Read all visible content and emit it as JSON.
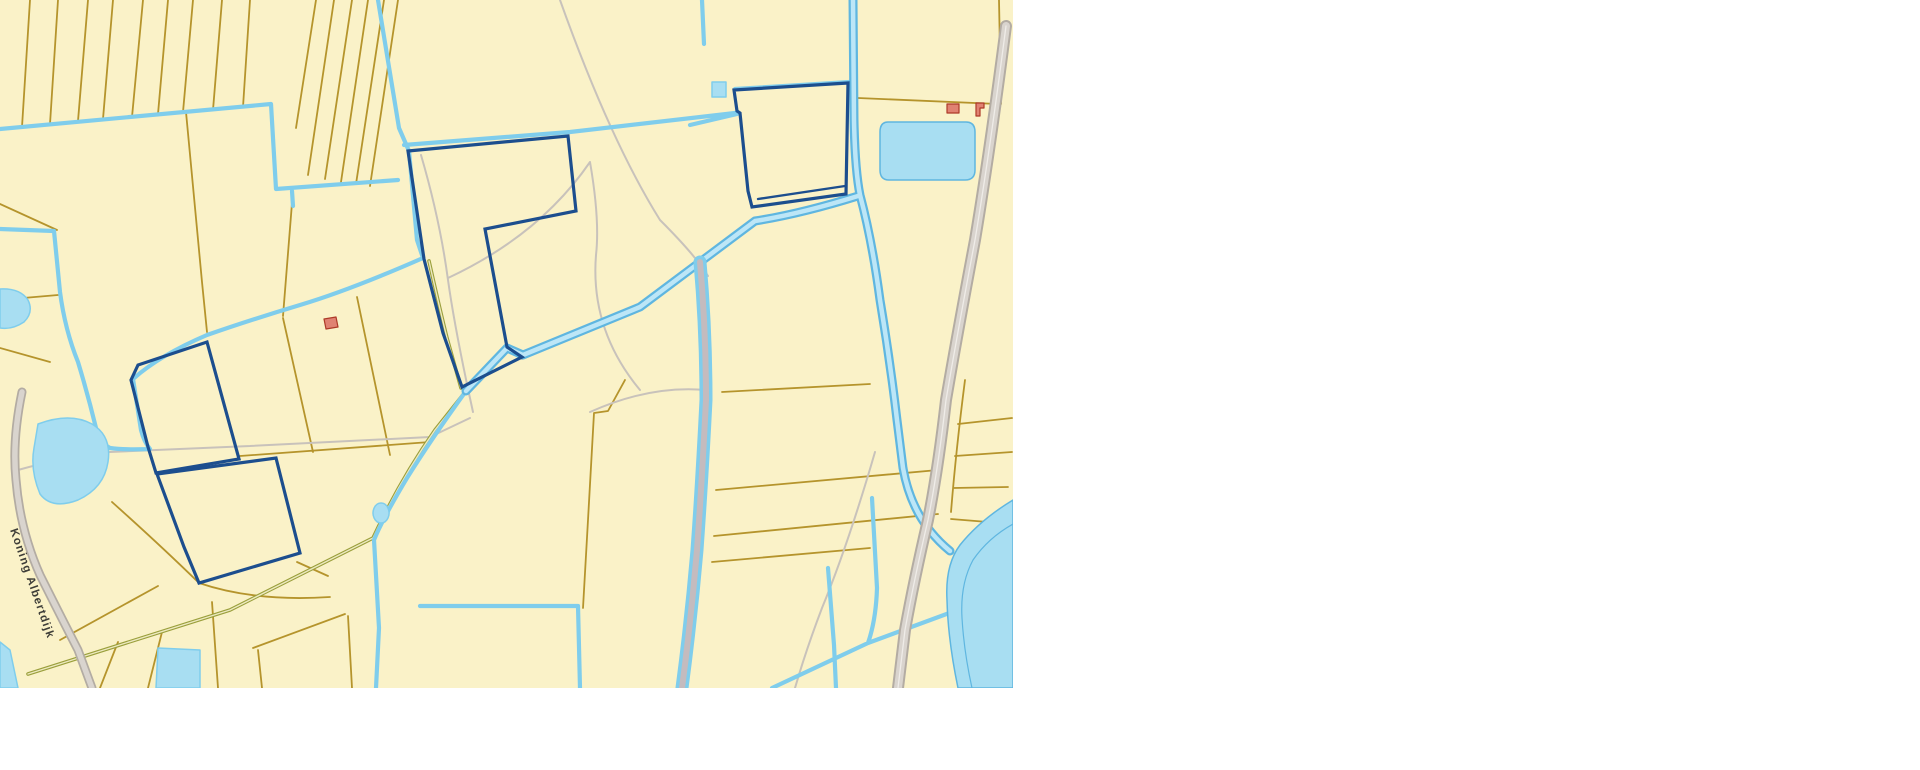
{
  "page": {
    "background": "#ffffff"
  },
  "map": {
    "width": 1013,
    "height": 688,
    "road_label": "Koning Albertdijk",
    "colors": {
      "parcel_fill": "#FAF2C8",
      "parcel_line": "#B5942C",
      "water_line": "#7FCDEC",
      "water_fill": "#A8DEF2",
      "water_deep": "#5FB6E0",
      "water_light": "#BCE6F7",
      "selection": "#1C4E8E",
      "road_casing": "#B3ACA3",
      "road_fill": "#D9D4CE",
      "road_center": "#EFECE8",
      "path_grey": "#C8C2BB",
      "towpath": "#C4BBBE",
      "dirt_road": "#9A9F3B",
      "dirt_center": "#EDE9C0",
      "building_fill": "#E08272",
      "building_stroke": "#AD3A28",
      "label_color": "#3E3E38"
    },
    "label": {
      "x": 10,
      "y": 530,
      "angle": 71,
      "size": 11.5
    },
    "features": [
      {
        "name": "map-background",
        "d": "M0,0 H1013 V688 H0 Z",
        "fill": "$parcel_fill",
        "stroke": "none",
        "w": 0,
        "inter": false
      },
      {
        "name": "parcel-lines-topleft",
        "d": "M30,0 L22,127 M58,0 L50,124 M88,0 L78,121 M113,0 L103,119 M143,0 L132,117 M168,0 L158,114 M193,0 L183,112 M222,0 L213,110 M250,0 L243,107 M316,0 L296,128 M334,0 L308,175 M352,0 L325,179 M368,0 L341,182 M384,0 L356,184 M398,0 L370,186 M186,112 L202,282 L207,332 M0,204 L57,230 M0,300 L58,295 M0,348 L50,362",
        "stroke": "$parcel_line",
        "w": 1.8,
        "fill": "none",
        "inter": false
      },
      {
        "name": "parcel-lines-center",
        "d": "M292,203 L283,316 M283,318 L313,452 M357,297 L390,455 M240,456 L430,442 M625,380 L608,411 L594,413 L588,520 L583,608 M112,502 Q160,545 198,582 M199,583 Q255,602 330,597 M297,562 L328,576",
        "stroke": "$parcel_line",
        "w": 1.8,
        "fill": "none",
        "inter": false
      },
      {
        "name": "parcel-lines-right",
        "d": "M722,392 L870,384 M716,490 L938,470 M714,536 L938,514 M712,562 L870,548 M858,98 L998,104 M999,0 L1001,104 M958,424 L1012,418 M955,456 L1012,452 M953,488 L1008,487 M951,519 L1000,523 M965,380 Q956,450 951,512",
        "stroke": "$parcel_line",
        "w": 1.8,
        "fill": "none",
        "inter": false
      },
      {
        "name": "parcel-lines-bottom",
        "d": "M60,640 L158,586 M100,688 L118,642 M148,688 L162,632 M212,602 L218,688 M253,648 L345,614 M258,650 L262,688 M348,616 L352,688",
        "stroke": "$parcel_line",
        "w": 1.8,
        "fill": "none",
        "inter": false
      },
      {
        "name": "footpaths",
        "d": "M421,155 Q440,220 448,280 Q455,330 473,412 M448,278 Q540,235 590,162 M590,162 Q600,220 596,255 Q590,330 640,390 M250,446 L430,437 L470,418 M18,470 Q60,458 110,452 L250,446 M560,0 Q610,140 660,220 Q696,256 708,276 M590,412 Q650,385 706,390 M875,452 Q848,545 822,608 Q806,650 795,688 M522,359 L640,310 L750,226",
        "stroke": "$path_grey",
        "w": 2,
        "fill": "none",
        "inter": false
      },
      {
        "name": "dirt-road",
        "d": "M28,674 L230,610 L373,538 M373,538 Q400,480 435,430 L466,391 M429,261 Q440,310 447,338 L461,388",
        "stroke": "$dirt_road",
        "w": 3.6,
        "fill": "none",
        "inter": false
      },
      {
        "name": "dirt-road-center",
        "d": "M28,674 L230,610 L373,538 M373,538 Q400,480 435,430 L466,391 M429,261 Q440,310 447,338 L461,388",
        "stroke": "$dirt_center",
        "w": 1.4,
        "fill": "none",
        "inter": false
      },
      {
        "name": "ditches-waterlines",
        "d": "M0,129 L271,104 L276,189 L398,180 M292,191 L293,206 M378,0 L399,128 L409,151 L417,240 L423,258 M423,258 Q350,290 300,305 Q250,320 207,335 Q160,355 133,379 L141,430 Q144,442 150,449 M150,449 Q125,450 110,448 L96,440 M0,229 L54,231 L60,292 Q65,330 78,362 Q88,395 96,428 M466,391 Q432,438 407,478 Q383,518 374,540 L379,628 L376,688 M420,606 L578,606 L580,688 M828,568 L834,645 L836,688 M872,498 L877,588 Q876,620 868,643 M772,688 L868,643 L952,612 M702,0 L704,44 M690,125 L737,114 M735,89 L850,82 M404,145 L570,132 L735,113",
        "stroke": "$water_line",
        "w": 4.2,
        "fill": "none",
        "inter": false
      },
      {
        "name": "canal-casing",
        "d": "M853,0 L854,120 Q855,170 860,195 Q872,240 880,300 Q890,360 897,420 L903,468 Q912,520 950,551 M858,196 Q800,214 755,221 L640,307 L523,355 L507,348 L466,391",
        "stroke": "$water_deep",
        "w": 9,
        "fill": "none",
        "inter": false
      },
      {
        "name": "canal-water",
        "d": "M853,0 L854,120 Q855,170 860,195 Q872,240 880,300 Q890,360 897,420 L903,468 Q912,520 950,551 M858,196 Q800,214 755,221 L640,307 L523,355 L507,348 L466,391",
        "stroke": "$water_light",
        "w": 4.5,
        "fill": "none",
        "inter": false
      },
      {
        "name": "double-canal",
        "d": "M700,262 Q706,330 706,400 Q702,480 697,550 Q691,620 682,688",
        "stroke": "$water_line",
        "w": 13,
        "fill": "none",
        "inter": false
      },
      {
        "name": "double-canal-towpath",
        "d": "M700,262 Q706,330 706,400 Q702,480 697,550 Q691,620 682,688",
        "stroke": "$towpath",
        "w": 6,
        "fill": "none",
        "inter": false
      },
      {
        "name": "ponds",
        "d": "M0,289 Q20,288 28,300 Q34,312 24,322 Q12,330 0,328 Z M38,424 Q70,412 92,424 Q112,436 108,462 Q104,488 78,500 Q52,510 40,494 Q30,470 34,448 Z M381,503 a8,10 0 1 0 0.1,0 Z M712,82 h14 v15 h-14 Z M158,648 L200,650 L200,688 L156,688 Z M0,642 L10,650 L18,688 L0,688 Z",
        "fill": "$water_fill",
        "stroke": "$water_line",
        "w": 1.5,
        "inter": false
      },
      {
        "name": "pond-topright",
        "d": "M888,122 h78 q9,0 9,10 v38 q0,10 -10,10 h-76 q-9,0 -9,-10 v-38 q0,-10 8,-10 Z",
        "fill": "$water_fill",
        "stroke": "$water_deep",
        "w": 1.5,
        "inter": false
      },
      {
        "name": "river-bend",
        "d": "M1013,500 Q980,520 960,545 Q945,565 947,600 Q948,640 958,688 L1013,688 Z",
        "fill": "$water_fill",
        "stroke": "$water_deep",
        "w": 1.5,
        "inter": false
      },
      {
        "name": "river-channel-line",
        "d": "M1013,524 Q988,538 973,560 Q960,584 962,618 Q964,652 972,688",
        "stroke": "$water_deep",
        "w": 1.2,
        "fill": "none",
        "inter": false
      },
      {
        "name": "highway-casing",
        "d": "M1006,26 Q990,150 975,240 Q958,330 946,400 Q938,470 928,520 Q914,580 905,630 L898,688",
        "stroke": "$road_casing",
        "w": 12,
        "fill": "none",
        "inter": false
      },
      {
        "name": "highway-fill",
        "d": "M1006,26 Q990,150 975,240 Q958,330 946,400 Q938,470 928,520 Q914,580 905,630 L898,688",
        "stroke": "$road_fill",
        "w": 8,
        "fill": "none",
        "inter": false
      },
      {
        "name": "highway-centerline",
        "d": "M1006,26 Q990,150 975,240 Q958,330 946,400 Q938,470 928,520 Q914,580 905,630 L898,688",
        "stroke": "$road_center",
        "w": 1.3,
        "fill": "none",
        "inter": false
      },
      {
        "name": "dike-road-casing",
        "d": "M22,392 Q12,440 16,480 Q20,530 40,575 Q60,615 78,650 L92,688",
        "stroke": "$road_casing",
        "w": 9,
        "fill": "none",
        "inter": false
      },
      {
        "name": "dike-road-fill",
        "d": "M22,392 Q12,440 16,480 Q20,530 40,575 Q60,615 78,650 L92,688",
        "stroke": "$road_fill",
        "w": 5.5,
        "fill": "none",
        "inter": false
      },
      {
        "name": "selected-parcel-north",
        "d": "M408,151 L568,136 L576,211 L485,229 L507,347 L522,357 L462,387 L443,333 L424,259 Z",
        "stroke": "$selection",
        "w": 3.2,
        "fill": "none",
        "join": "miter",
        "inter": true
      },
      {
        "name": "selected-parcel-northeast",
        "d": "M737,111 L734,90 L848,83 L846,194 L752,207 L748,191 L740,113 Z",
        "stroke": "$selection",
        "w": 3.2,
        "fill": "none",
        "join": "miter",
        "inter": true
      },
      {
        "name": "selected-parcel-northeast-inner",
        "d": "M845,186 L758,199",
        "stroke": "$selection",
        "w": 2.4,
        "fill": "none",
        "inter": true
      },
      {
        "name": "selected-parcel-west-upper",
        "d": "M207,342 L239,459 L156,473 L148,447 L131,380 L138,365 Z",
        "stroke": "$selection",
        "w": 3.2,
        "fill": "none",
        "join": "miter",
        "inter": true
      },
      {
        "name": "selected-parcel-west-lower",
        "d": "M157,474 L276,458 L300,553 L199,583 L184,547 Z",
        "stroke": "$selection",
        "w": 3.2,
        "fill": "none",
        "join": "miter",
        "inter": true
      },
      {
        "name": "building-symbols",
        "d": "M324,319 L336,317 L338,327 L326,329 Z M947,104 L959,104 L959,113 L947,113 Z M976,103 L984,103 L984,108 L980,108 L980,116 L976,116 Z",
        "fill": "$building_fill",
        "stroke": "$building_stroke",
        "w": 1.2,
        "inter": false
      }
    ]
  }
}
